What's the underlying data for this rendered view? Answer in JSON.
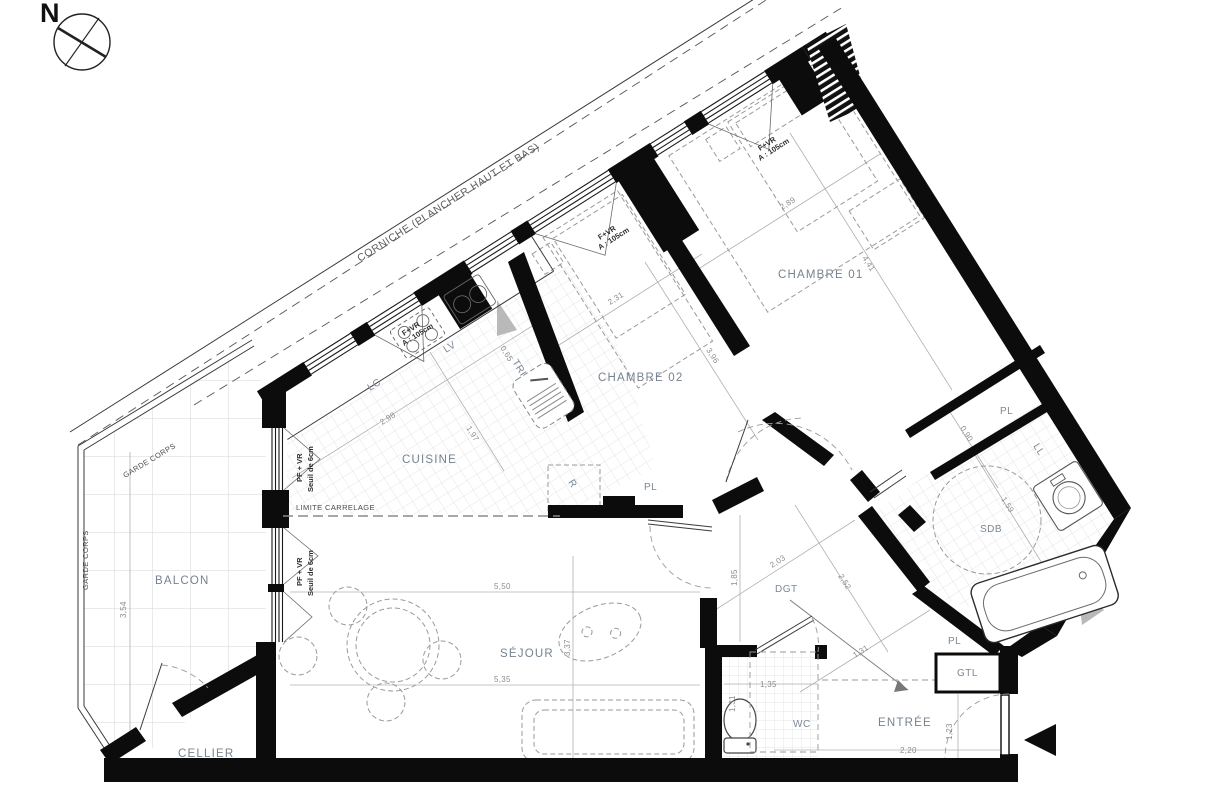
{
  "plan": {
    "compass_n": "N",
    "corniche": "CORNICHE (PLANCHER HAUT ET BAS)",
    "garde_corps": "GARDE CORPS",
    "limite_carrelage": "LIMITE CARRELAGE",
    "rooms": {
      "balcon": "BALCON",
      "cellier": "CELLIER",
      "sejour": "SÉJOUR",
      "cuisine": "CUISINE",
      "chambre01": "CHAMBRE 01",
      "chambre02": "CHAMBRE 02",
      "dgt": "DGT",
      "sdb": "SDB",
      "wc": "WC",
      "entree": "ENTRÉE",
      "gtl": "GTL",
      "pl": "PL"
    },
    "fixtures": {
      "lc": "LC",
      "lv": "LV",
      "tri": "TRI",
      "fridge": "R",
      "ll": "LL"
    },
    "window_labels": {
      "fvr": "F+VR",
      "fvr_detail": "A : 105cm",
      "pfvr": "PF + VR",
      "pfvr_detail": "Seuil de 6cm"
    },
    "dims": {
      "balcon_depth": "3,54",
      "sejour_width_top": "5,50",
      "sejour_height": "3,37",
      "sejour_width_bottom": "5,35",
      "cuisine_width": "2,98",
      "cuisine_depth": "1,97",
      "tri_width": "0,65",
      "chambre02_width": "2,31",
      "chambre02_depth": "3,96",
      "chambre01_width": "2,89",
      "chambre01_depth": "4,41",
      "dgt_width": "2,03",
      "dgt_height": "1,85",
      "dgt_diag": "2,52",
      "sdb_door": "0,90",
      "sdb_depth": "1,59",
      "wc_width": "1,35",
      "wc_depth": "1,31",
      "entree_diag": "1,31",
      "entree_width": "2,20",
      "entree_door": "1,23"
    }
  }
}
